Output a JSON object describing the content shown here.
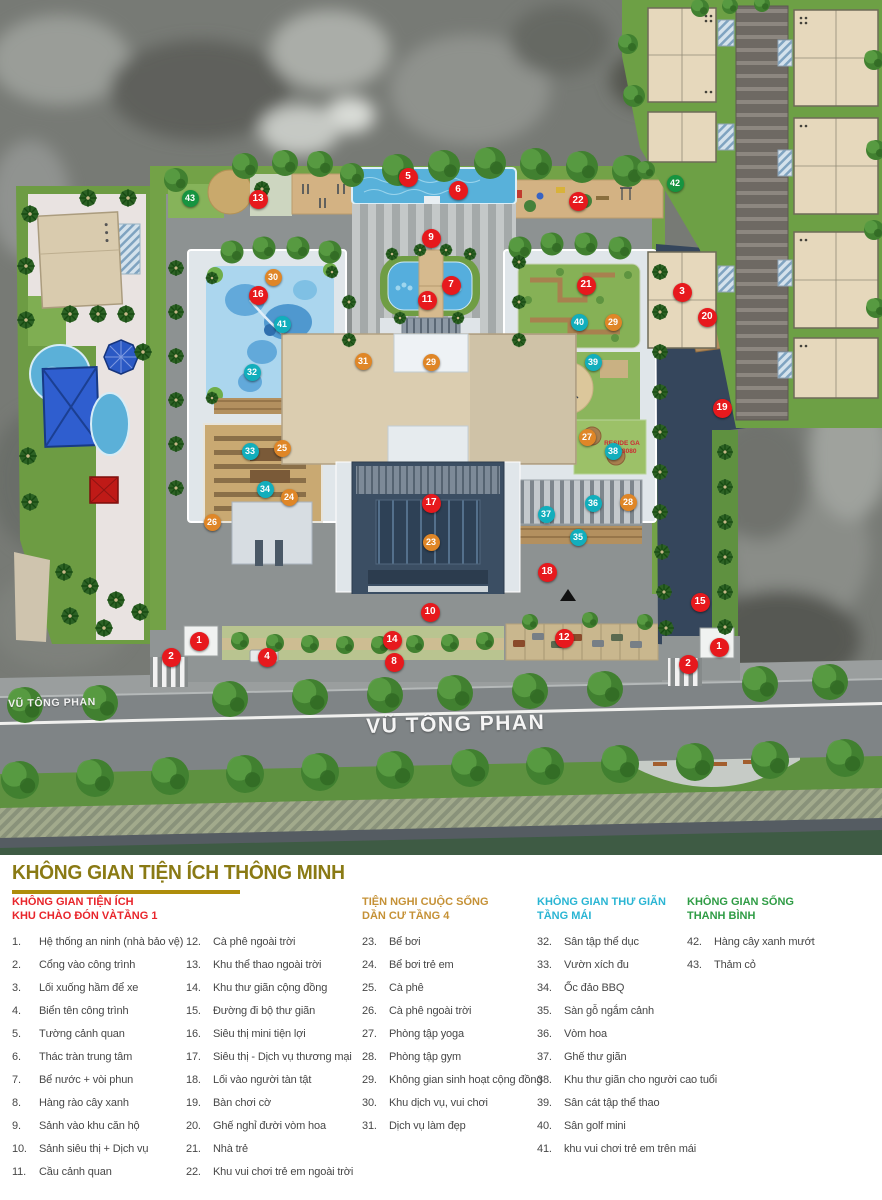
{
  "plan": {
    "road_label_small": "VŨ TÔNG PHAN",
    "road_label_large": "VŨ TÔNG PHAN",
    "watermark_line1": "RESIDE GA",
    "watermark_line2": "06333080",
    "marker_colors": {
      "red": "#e7191d",
      "orange": "#df8627",
      "teal": "#12aebc",
      "green": "#169440"
    },
    "markers": [
      {
        "n": "1",
        "c": "red",
        "x": 199,
        "y": 641
      },
      {
        "n": "2",
        "c": "red",
        "x": 171,
        "y": 657
      },
      {
        "n": "4",
        "c": "red",
        "x": 267,
        "y": 657
      },
      {
        "n": "8",
        "c": "red",
        "x": 394,
        "y": 662
      },
      {
        "n": "14",
        "c": "red",
        "x": 392,
        "y": 640
      },
      {
        "n": "12",
        "c": "red",
        "x": 564,
        "y": 638
      },
      {
        "n": "10",
        "c": "red",
        "x": 430,
        "y": 612
      },
      {
        "n": "18",
        "c": "red",
        "x": 547,
        "y": 572
      },
      {
        "n": "17",
        "c": "red",
        "x": 431,
        "y": 503
      },
      {
        "n": "16",
        "c": "red",
        "x": 258,
        "y": 295
      },
      {
        "n": "13",
        "c": "red",
        "x": 258,
        "y": 199
      },
      {
        "n": "5",
        "c": "red",
        "x": 408,
        "y": 177
      },
      {
        "n": "6",
        "c": "red",
        "x": 458,
        "y": 190
      },
      {
        "n": "9",
        "c": "red",
        "x": 431,
        "y": 238
      },
      {
        "n": "7",
        "c": "red",
        "x": 451,
        "y": 285
      },
      {
        "n": "11",
        "c": "red",
        "x": 427,
        "y": 300
      },
      {
        "n": "21",
        "c": "red",
        "x": 586,
        "y": 285
      },
      {
        "n": "22",
        "c": "red",
        "x": 578,
        "y": 201
      },
      {
        "n": "3",
        "c": "red",
        "x": 682,
        "y": 292
      },
      {
        "n": "20",
        "c": "red",
        "x": 707,
        "y": 317
      },
      {
        "n": "19",
        "c": "red",
        "x": 722,
        "y": 408
      },
      {
        "n": "15",
        "c": "red",
        "x": 700,
        "y": 602
      },
      {
        "n": "1",
        "c": "red",
        "x": 719,
        "y": 647
      },
      {
        "n": "2",
        "c": "red",
        "x": 688,
        "y": 664
      },
      {
        "n": "30",
        "c": "orange",
        "x": 273,
        "y": 277
      },
      {
        "n": "31",
        "c": "orange",
        "x": 363,
        "y": 361
      },
      {
        "n": "29",
        "c": "orange",
        "x": 431,
        "y": 362
      },
      {
        "n": "29",
        "c": "orange",
        "x": 613,
        "y": 322
      },
      {
        "n": "25",
        "c": "orange",
        "x": 282,
        "y": 448
      },
      {
        "n": "24",
        "c": "orange",
        "x": 289,
        "y": 497
      },
      {
        "n": "26",
        "c": "orange",
        "x": 212,
        "y": 522
      },
      {
        "n": "23",
        "c": "orange",
        "x": 431,
        "y": 542
      },
      {
        "n": "27",
        "c": "orange",
        "x": 587,
        "y": 437
      },
      {
        "n": "28",
        "c": "orange",
        "x": 628,
        "y": 502
      },
      {
        "n": "41",
        "c": "teal",
        "x": 282,
        "y": 324
      },
      {
        "n": "32",
        "c": "teal",
        "x": 252,
        "y": 372
      },
      {
        "n": "33",
        "c": "teal",
        "x": 250,
        "y": 451
      },
      {
        "n": "34",
        "c": "teal",
        "x": 265,
        "y": 489
      },
      {
        "n": "40",
        "c": "teal",
        "x": 579,
        "y": 322
      },
      {
        "n": "39",
        "c": "teal",
        "x": 593,
        "y": 362
      },
      {
        "n": "38",
        "c": "teal",
        "x": 613,
        "y": 451
      },
      {
        "n": "37",
        "c": "teal",
        "x": 546,
        "y": 514
      },
      {
        "n": "36",
        "c": "teal",
        "x": 593,
        "y": 503
      },
      {
        "n": "35",
        "c": "teal",
        "x": 578,
        "y": 537
      },
      {
        "n": "42",
        "c": "green",
        "x": 675,
        "y": 183
      },
      {
        "n": "43",
        "c": "green",
        "x": 190,
        "y": 198
      }
    ]
  },
  "legend": {
    "title": "KHÔNG GIAN TIỆN ÍCH THÔNG MINH",
    "columns": [
      {
        "header_lines": [
          "KHÔNG GIAN TIỆN ÍCH",
          "KHU CHÀO ĐÓN VÀTẦNG 1"
        ],
        "header_color": "#e8252b",
        "items": [
          {
            "n": "1",
            "t": "Hệ thống an ninh (nhà bảo vệ)"
          },
          {
            "n": "2",
            "t": "Cổng vào công trình"
          },
          {
            "n": "3",
            "t": "Lối xuống hầm để xe"
          },
          {
            "n": "4",
            "t": "Biển tên công trình"
          },
          {
            "n": "5",
            "t": "Tường cảnh quan"
          },
          {
            "n": "6",
            "t": "Thác tràn trung tâm"
          },
          {
            "n": "7",
            "t": "Bể nước + vòi phun"
          },
          {
            "n": "8",
            "t": "Hàng rào cây xanh"
          },
          {
            "n": "9",
            "t": "Sảnh vào khu căn hộ"
          },
          {
            "n": "10",
            "t": "Sảnh siêu thị + Dịch vụ"
          },
          {
            "n": "11",
            "t": "Cầu cảnh quan"
          }
        ]
      },
      {
        "header_lines": [],
        "header_color": "",
        "items": [
          {
            "n": "12",
            "t": "Cà phê ngoài trời"
          },
          {
            "n": "13",
            "t": "Khu thể thao ngoài trời"
          },
          {
            "n": "14",
            "t": "Khu thư giãn cộng đồng"
          },
          {
            "n": "15",
            "t": "Đường đi bộ thư giãn"
          },
          {
            "n": "16",
            "t": "Siêu thị mini tiện lợi"
          },
          {
            "n": "17",
            "t": "Siêu thị - Dịch vụ thương mại"
          },
          {
            "n": "18",
            "t": "Lối vào người tàn tật"
          },
          {
            "n": "19",
            "t": "Bàn chơi cờ"
          },
          {
            "n": "20",
            "t": "Ghế nghỉ đười vòm hoa"
          },
          {
            "n": "21",
            "t": "Nhà trẻ"
          },
          {
            "n": "22",
            "t": "Khu vui chơi trẻ em ngoài trời"
          }
        ]
      },
      {
        "header_lines": [
          "TIỆN NGHI CUỘC SỐNG",
          "DẦN CƯ TẦNG 4"
        ],
        "header_color": "#c59136",
        "items": [
          {
            "n": "23",
            "t": "Bể bơi"
          },
          {
            "n": "24",
            "t": "Bể bơi trẻ em"
          },
          {
            "n": "25",
            "t": "Cà phê"
          },
          {
            "n": "26",
            "t": "Cà phê ngoài trời"
          },
          {
            "n": "27",
            "t": "Phòng tập yoga"
          },
          {
            "n": "28",
            "t": "Phòng tập gym"
          },
          {
            "n": "29",
            "t": "Không gian sinh hoạt cộng đồng"
          },
          {
            "n": "30",
            "t": "Khu dịch vụ, vui chơi"
          },
          {
            "n": "31",
            "t": "Dịch vụ làm đẹp"
          }
        ]
      },
      {
        "header_lines": [
          "KHÔNG GIAN THƯ GIÃN",
          "TẦNG MÁI"
        ],
        "header_color": "#2ab5d3",
        "items": [
          {
            "n": "32",
            "t": "Sân tập thể dục"
          },
          {
            "n": "33",
            "t": "Vườn xích đu"
          },
          {
            "n": "34",
            "t": "Ốc đảo BBQ"
          },
          {
            "n": "35",
            "t": "Sàn gỗ ngắm cảnh"
          },
          {
            "n": "36",
            "t": "Vòm hoa"
          },
          {
            "n": "37",
            "t": "Ghế thư giãn"
          },
          {
            "n": "38",
            "t": "Khu thư giãn cho người cao tuổi"
          },
          {
            "n": "39",
            "t": "Sân cát tập thể thao"
          },
          {
            "n": "40",
            "t": "Sân golf mini"
          },
          {
            "n": "41",
            "t": "khu vui chơi trẻ em trên mái"
          }
        ]
      },
      {
        "header_lines": [
          "KHÔNG GIAN SỐNG",
          "THANH BÌNH"
        ],
        "header_color": "#2f9c45",
        "items": [
          {
            "n": "42",
            "t": "Hàng cây xanh mướt"
          },
          {
            "n": "43",
            "t": "Thảm cỏ"
          }
        ]
      }
    ]
  }
}
